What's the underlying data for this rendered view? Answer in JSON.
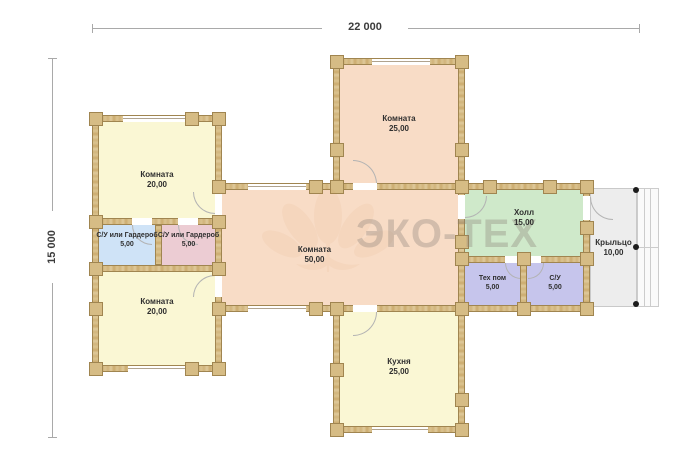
{
  "plan": {
    "title_hint": "floor-plan",
    "dimension_width_label": "22 000",
    "dimension_height_label": "15 000",
    "watermark_text": "ЭКО-ТЕХ",
    "rooms": {
      "room_top_center": {
        "name": "Комната",
        "area": "25,00"
      },
      "room_left_top": {
        "name": "Комната",
        "area": "20,00"
      },
      "closet_blue": {
        "name": "С/У или Гардероб",
        "area": "5,00"
      },
      "closet_pink": {
        "name": "С/У или Гардероб",
        "area": "5,00"
      },
      "room_left_bottom": {
        "name": "Комната",
        "area": "20,00"
      },
      "room_center": {
        "name": "Комната",
        "area": "50,00"
      },
      "hall": {
        "name": "Холл",
        "area": "15,00"
      },
      "tech_room": {
        "name": "Тех пом",
        "area": "5,00"
      },
      "bathroom": {
        "name": "С/У",
        "area": "5,00"
      },
      "porch": {
        "name": "Крыльцо",
        "area": "10,00"
      },
      "kitchen": {
        "name": "Кухня",
        "area": "25,00"
      }
    },
    "colors": {
      "room_peach": "#f8dcc6",
      "room_yellow": "#faf7d4",
      "room_blue": "#cfe3f7",
      "room_pink": "#ecccd3",
      "room_green": "#cfe9ca",
      "room_lavender": "#c6c5ec",
      "porch_gray": "#ededed",
      "wall_wood": "#d6bc85"
    }
  }
}
